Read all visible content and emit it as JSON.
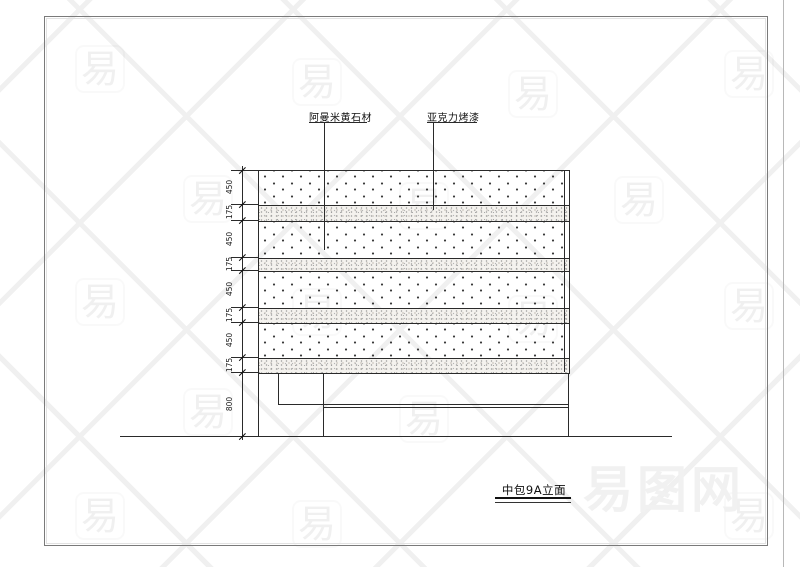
{
  "watermark": {
    "glyph": "易",
    "logo_text": "易图网"
  },
  "callouts": {
    "stone": "阿曼米黄石材",
    "acrylic": "亚克力烤漆"
  },
  "dimensions": {
    "left": [
      "450",
      "175",
      "450",
      "175",
      "450",
      "175",
      "450",
      "175",
      "800"
    ]
  },
  "title": {
    "text": "中包9A立面"
  }
}
